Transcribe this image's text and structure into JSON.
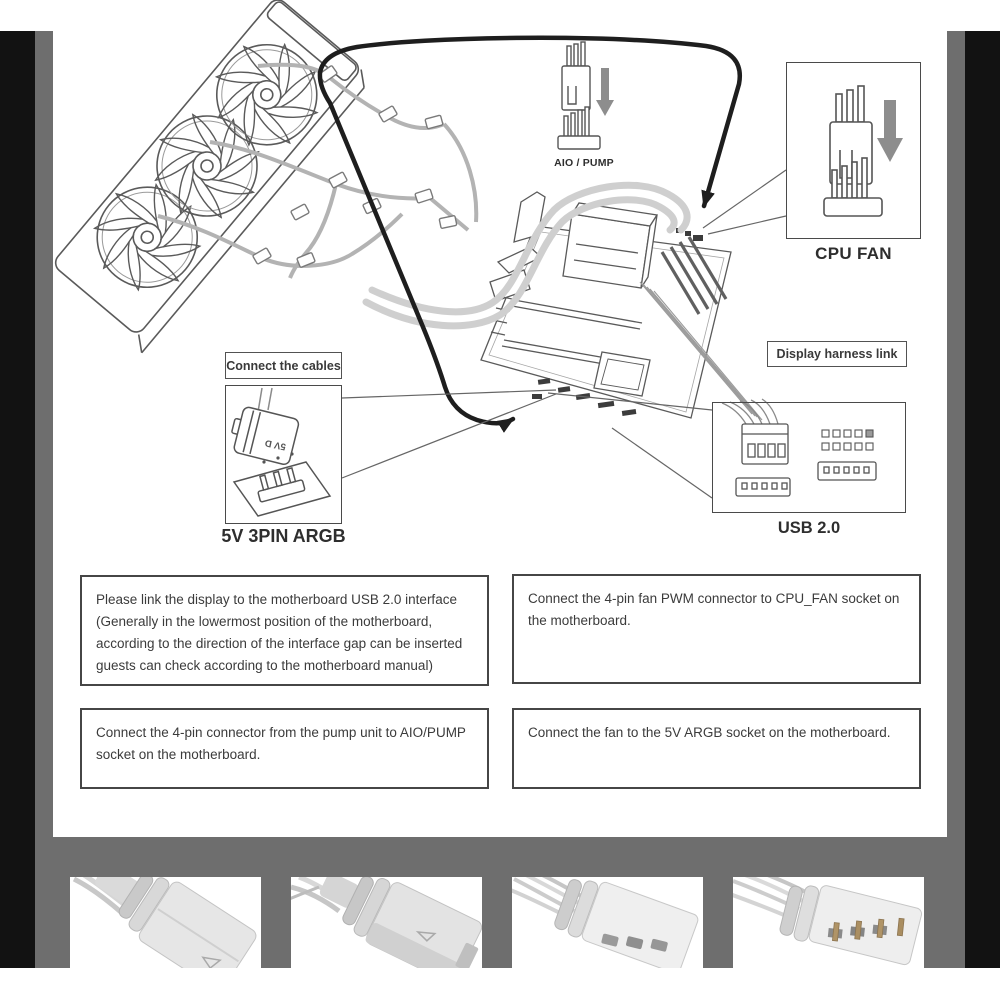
{
  "diagram": {
    "labels": {
      "aio_pump": "AIO / PUMP",
      "cpu_fan": "CPU FAN",
      "display_harness": "Display harness link",
      "connect_cables": "Connect the cables",
      "argb": "5V 3PIN ARGB",
      "usb": "USB 2.0",
      "argb_plug_marking": "5V D"
    }
  },
  "instructions": [
    "Please link the display to the motherboard USB 2.0 interface (Generally in the lowermost position of the motherboard, according to the direction of the interface gap can be inserted guests can check according to the motherboard manual)",
    "Connect the 4-pin fan PWM connector to CPU_FAN socket on the motherboard.",
    "Connect the 4-pin connector from the pump unit to AIO/PUMP socket on the motherboard.",
    "Connect the fan to the 5V ARGB socket on the motherboard."
  ],
  "colors": {
    "frame_black": "#121212",
    "frame_gray": "#6e6e6e",
    "panel_bg": "#ffffff",
    "line_art": "#555555",
    "cable_black": "#1e1e1e",
    "cable_gray": "#b3b3b3",
    "tube_gray": "#cfcfcf",
    "arrow_gray": "#8d8d8d",
    "text": "#3b3b3b"
  }
}
